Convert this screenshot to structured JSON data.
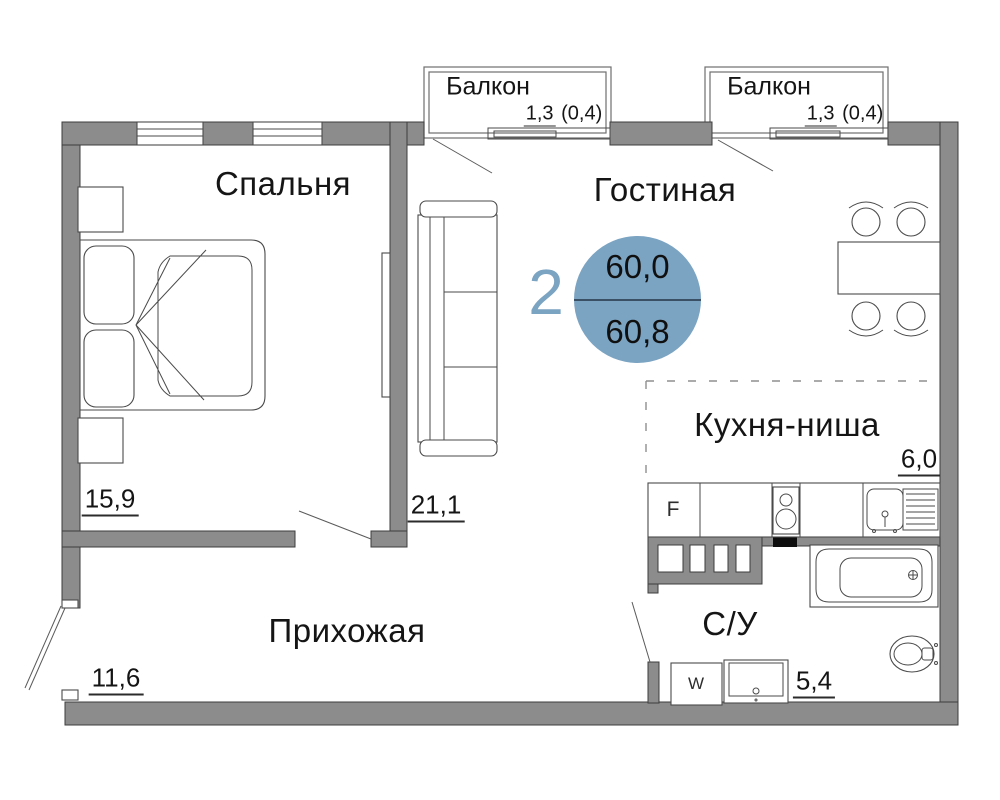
{
  "plan": {
    "rooms": {
      "bedroom": {
        "label": "Спальня",
        "area": "15,9"
      },
      "living": {
        "label": "Гостиная",
        "area": "21,1"
      },
      "kitchen": {
        "label": "Кухня-ниша",
        "area": "6,0"
      },
      "hallway": {
        "label": "Прихожая",
        "area": "11,6"
      },
      "bathroom": {
        "label": "С/У",
        "area": "5,4"
      },
      "balcony1": {
        "label": "Балкон",
        "area_main": "1,3",
        "area_reduced": "(0,4)"
      },
      "balcony2": {
        "label": "Балкон",
        "area_main": "1,3",
        "area_reduced": "(0,4)"
      }
    },
    "badge": {
      "rooms_count": "2",
      "total_area": "60,0",
      "living_area": "60,8"
    },
    "appliances": {
      "fridge": "F",
      "washing_machine": "W"
    },
    "colors": {
      "wall": "#8c8c8c",
      "badge_fill": "#7BA3C2",
      "accent_text": "#7BA3C2",
      "badge_divider": "#3a5064"
    }
  }
}
